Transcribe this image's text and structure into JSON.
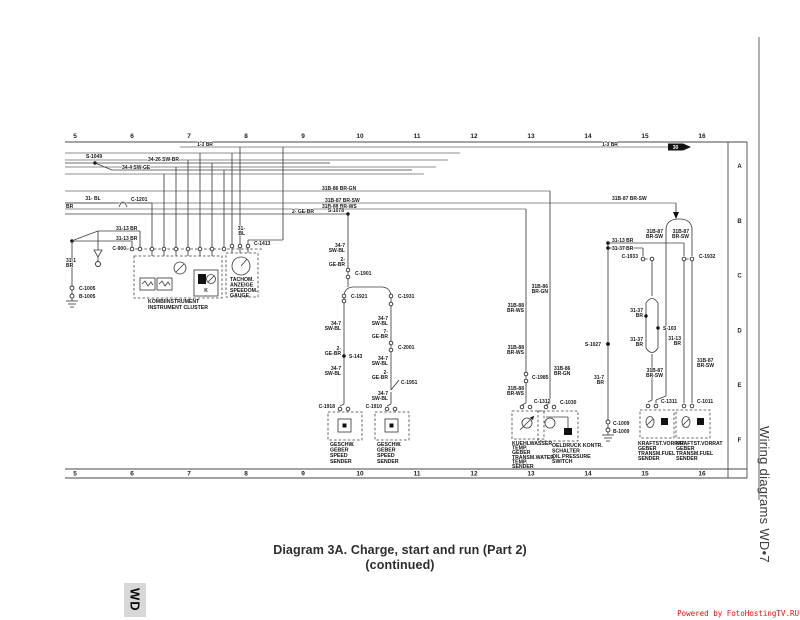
{
  "page": {
    "caption": {
      "line1": "Diagram 3A. Charge, start and run (Part 2)",
      "line2": "(continued)"
    },
    "side_label": "Wiring diagrams WD•7",
    "corner_tab": "WD",
    "watermark": "Powered by FotoHostingTV.RU",
    "colors": {
      "wire": "#3f3f3f",
      "watermark_red": "#e81010",
      "tab_gray": "#d8d8d8"
    }
  },
  "diagram": {
    "grid_columns": [
      "5",
      "6",
      "7",
      "8",
      "9",
      "10",
      "11",
      "12",
      "13",
      "14",
      "15",
      "16"
    ],
    "row_letters": [
      "A",
      "B",
      "C",
      "D",
      "E",
      "F"
    ],
    "arrow_box_label": "30",
    "wire_labels": [
      {
        "t": "1-3 BR",
        "x": 205,
        "y": 146,
        "a": "m"
      },
      {
        "t": "1-3 BR",
        "x": 610,
        "y": 146,
        "a": "m"
      },
      {
        "t": "S-1049",
        "x": 86,
        "y": 158,
        "a": "s"
      },
      {
        "t": "34-26 SW-BR",
        "x": 148,
        "y": 161,
        "a": "s"
      },
      {
        "t": "34-4 SW-GE",
        "x": 122,
        "y": 169,
        "a": "s"
      },
      {
        "t": "31- BL",
        "x": 93,
        "y": 200,
        "a": "m"
      },
      {
        "t": "BR",
        "x": 66,
        "y": 208,
        "a": "s"
      },
      {
        "t": "C-1201",
        "x": 131,
        "y": 201,
        "a": "s"
      },
      {
        "t": "31B-86 BR-GN",
        "x": 322,
        "y": 190,
        "a": "s"
      },
      {
        "t": "31B-87 BR-SW",
        "x": 325,
        "y": 202,
        "a": "s"
      },
      {
        "t": "31B-87 BR-SW",
        "x": 612,
        "y": 200,
        "a": "s"
      },
      {
        "t": "31B-88 BR-WS",
        "x": 322,
        "y": 208,
        "a": "s"
      },
      {
        "t": "2- GE-BR",
        "x": 292,
        "y": 213,
        "a": "s"
      },
      {
        "t": "S-1078",
        "x": 344,
        "y": 212,
        "a": "e"
      },
      {
        "t": "31-13 BR",
        "x": 116,
        "y": 230,
        "a": "s"
      },
      {
        "t": "31-13 BR",
        "x": 116,
        "y": 240,
        "a": "s"
      },
      {
        "t": "31-1",
        "x": 66,
        "y": 262,
        "a": "s"
      },
      {
        "t": "BR",
        "x": 66,
        "y": 267,
        "a": "s"
      },
      {
        "t": "C-1005",
        "x": 79,
        "y": 290,
        "a": "s"
      },
      {
        "t": "B-1005",
        "x": 79,
        "y": 298,
        "a": "s"
      },
      {
        "t": "C-900",
        "x": 126,
        "y": 250,
        "a": "e"
      },
      {
        "t": "C-1413",
        "x": 254,
        "y": 245,
        "a": "s"
      },
      {
        "t": "31-",
        "x": 245,
        "y": 230,
        "a": "e"
      },
      {
        "t": "BL",
        "x": 245,
        "y": 235,
        "a": "e"
      },
      {
        "t": "K",
        "x": 206,
        "y": 292,
        "a": "m"
      },
      {
        "t": "34-7",
        "x": 345,
        "y": 247,
        "a": "e"
      },
      {
        "t": "SW-BL",
        "x": 345,
        "y": 252,
        "a": "e"
      },
      {
        "t": "2-",
        "x": 345,
        "y": 261,
        "a": "e"
      },
      {
        "t": "GE-BR",
        "x": 345,
        "y": 266,
        "a": "e"
      },
      {
        "t": "C-1901",
        "x": 355,
        "y": 275,
        "a": "s"
      },
      {
        "t": "C-1921",
        "x": 351,
        "y": 298,
        "a": "s"
      },
      {
        "t": "C-1931",
        "x": 398,
        "y": 298,
        "a": "s"
      },
      {
        "t": "34-7",
        "x": 341,
        "y": 325,
        "a": "e"
      },
      {
        "t": "SW-BL",
        "x": 341,
        "y": 330,
        "a": "e"
      },
      {
        "t": "2-",
        "x": 341,
        "y": 350,
        "a": "e"
      },
      {
        "t": "GE-BR",
        "x": 341,
        "y": 355,
        "a": "e"
      },
      {
        "t": "S-143",
        "x": 349,
        "y": 358,
        "a": "s"
      },
      {
        "t": "34-7",
        "x": 341,
        "y": 370,
        "a": "e"
      },
      {
        "t": "SW-BL",
        "x": 341,
        "y": 375,
        "a": "e"
      },
      {
        "t": "C-1918",
        "x": 335,
        "y": 408,
        "a": "e"
      },
      {
        "t": "34-7",
        "x": 388,
        "y": 320,
        "a": "e"
      },
      {
        "t": "SW-BL",
        "x": 388,
        "y": 325,
        "a": "e"
      },
      {
        "t": "7-",
        "x": 388,
        "y": 333,
        "a": "e"
      },
      {
        "t": "GE-BR",
        "x": 388,
        "y": 338,
        "a": "e"
      },
      {
        "t": "C-2001",
        "x": 398,
        "y": 349,
        "a": "s"
      },
      {
        "t": "34-7",
        "x": 388,
        "y": 360,
        "a": "e"
      },
      {
        "t": "SW-BL",
        "x": 388,
        "y": 365,
        "a": "e"
      },
      {
        "t": "2-",
        "x": 388,
        "y": 374,
        "a": "e"
      },
      {
        "t": "GE-BR",
        "x": 388,
        "y": 379,
        "a": "e"
      },
      {
        "t": "C-1951",
        "x": 401,
        "y": 384,
        "a": "s"
      },
      {
        "t": "34-7",
        "x": 388,
        "y": 395,
        "a": "e"
      },
      {
        "t": "SW-BL",
        "x": 388,
        "y": 400,
        "a": "e"
      },
      {
        "t": "C-1910",
        "x": 382,
        "y": 408,
        "a": "e"
      },
      {
        "t": "31B-86",
        "x": 548,
        "y": 288,
        "a": "e"
      },
      {
        "t": "BR-GN",
        "x": 548,
        "y": 293,
        "a": "e"
      },
      {
        "t": "31B-88",
        "x": 524,
        "y": 307,
        "a": "e"
      },
      {
        "t": "BR-WS",
        "x": 524,
        "y": 312,
        "a": "e"
      },
      {
        "t": "31B-88",
        "x": 524,
        "y": 349,
        "a": "e"
      },
      {
        "t": "BR-WS",
        "x": 524,
        "y": 354,
        "a": "e"
      },
      {
        "t": "31B-86",
        "x": 554,
        "y": 370,
        "a": "s"
      },
      {
        "t": "BR-GN",
        "x": 554,
        "y": 375,
        "a": "s"
      },
      {
        "t": "C-1985",
        "x": 532,
        "y": 379,
        "a": "s"
      },
      {
        "t": "31B-88",
        "x": 524,
        "y": 390,
        "a": "e"
      },
      {
        "t": "BR-WS",
        "x": 524,
        "y": 395,
        "a": "e"
      },
      {
        "t": "C-1312",
        "x": 534,
        "y": 403,
        "a": "s"
      },
      {
        "t": "C-1030",
        "x": 560,
        "y": 404,
        "a": "s"
      },
      {
        "t": "S-1027",
        "x": 601,
        "y": 346,
        "a": "e"
      },
      {
        "t": "31-7",
        "x": 604,
        "y": 379,
        "a": "e"
      },
      {
        "t": "BR",
        "x": 604,
        "y": 384,
        "a": "e"
      },
      {
        "t": "C-1009",
        "x": 613,
        "y": 425,
        "a": "s"
      },
      {
        "t": "B-1009",
        "x": 613,
        "y": 433,
        "a": "s"
      },
      {
        "t": "31-13 BR",
        "x": 612,
        "y": 242,
        "a": "s"
      },
      {
        "t": "31-37 BR",
        "x": 612,
        "y": 250,
        "a": "s"
      },
      {
        "t": "C-1933",
        "x": 638,
        "y": 258,
        "a": "e"
      },
      {
        "t": "C-1932",
        "x": 699,
        "y": 258,
        "a": "s"
      },
      {
        "t": "31B-87",
        "x": 663,
        "y": 233,
        "a": "e"
      },
      {
        "t": "BR-SW",
        "x": 663,
        "y": 238,
        "a": "e"
      },
      {
        "t": "31B-87",
        "x": 689,
        "y": 233,
        "a": "e"
      },
      {
        "t": "BR-SW",
        "x": 689,
        "y": 238,
        "a": "e"
      },
      {
        "t": "31-37",
        "x": 643,
        "y": 312,
        "a": "e"
      },
      {
        "t": "BR",
        "x": 643,
        "y": 317,
        "a": "e"
      },
      {
        "t": "S-103",
        "x": 663,
        "y": 330,
        "a": "s"
      },
      {
        "t": "31-37",
        "x": 643,
        "y": 341,
        "a": "e"
      },
      {
        "t": "BR",
        "x": 643,
        "y": 346,
        "a": "e"
      },
      {
        "t": "31-13",
        "x": 681,
        "y": 340,
        "a": "e"
      },
      {
        "t": "BR",
        "x": 681,
        "y": 345,
        "a": "e"
      },
      {
        "t": "31B-87",
        "x": 663,
        "y": 372,
        "a": "e"
      },
      {
        "t": "BR-SW",
        "x": 663,
        "y": 377,
        "a": "e"
      },
      {
        "t": "31B-87",
        "x": 697,
        "y": 362,
        "a": "s"
      },
      {
        "t": "BR-SW",
        "x": 697,
        "y": 367,
        "a": "s"
      },
      {
        "t": "C-1311",
        "x": 661,
        "y": 403,
        "a": "s"
      },
      {
        "t": "C-1011",
        "x": 697,
        "y": 403,
        "a": "s"
      }
    ],
    "component_labels": [
      {
        "lines": [
          "KOMBIINSTRUMENT",
          "INSTRUMENT CLUSTER"
        ],
        "x": 148,
        "y": 303,
        "lh": 6
      },
      {
        "lines": [
          "TACHOM.",
          "ANZEIGE",
          "SPEEDOM.",
          "GAUGE"
        ],
        "x": 230,
        "y": 281,
        "lh": 5.4
      },
      {
        "lines": [
          "GESCHW.",
          "GEBER",
          "SPEED",
          "SENDER"
        ],
        "x": 330,
        "y": 446,
        "lh": 5.6
      },
      {
        "lines": [
          "GESCHW.",
          "GEBER",
          "SPEED",
          "SENDER"
        ],
        "x": 377,
        "y": 446,
        "lh": 5.6
      },
      {
        "lines": [
          "KUEHLWASSER",
          "TEMP.",
          "GEBER",
          "TRANSM.WATER",
          "TEMP.",
          "SENDER"
        ],
        "x": 512,
        "y": 445,
        "lh": 4.6
      },
      {
        "lines": [
          "OELDRUCK KONTR.",
          "SCHALTER",
          "OIL PRESSURE",
          "SWITCH"
        ],
        "x": 552,
        "y": 447,
        "lh": 5.4
      },
      {
        "lines": [
          "KRAFTST.VORRAT",
          "GEBER",
          "TRANSM.FUEL",
          "SENDER"
        ],
        "x": 638,
        "y": 445,
        "lh": 5
      },
      {
        "lines": [
          "KRAFTST.VORRAT",
          "GEBER",
          "TRANSM.FUEL",
          "SENDER"
        ],
        "x": 676,
        "y": 445,
        "lh": 5
      }
    ]
  }
}
